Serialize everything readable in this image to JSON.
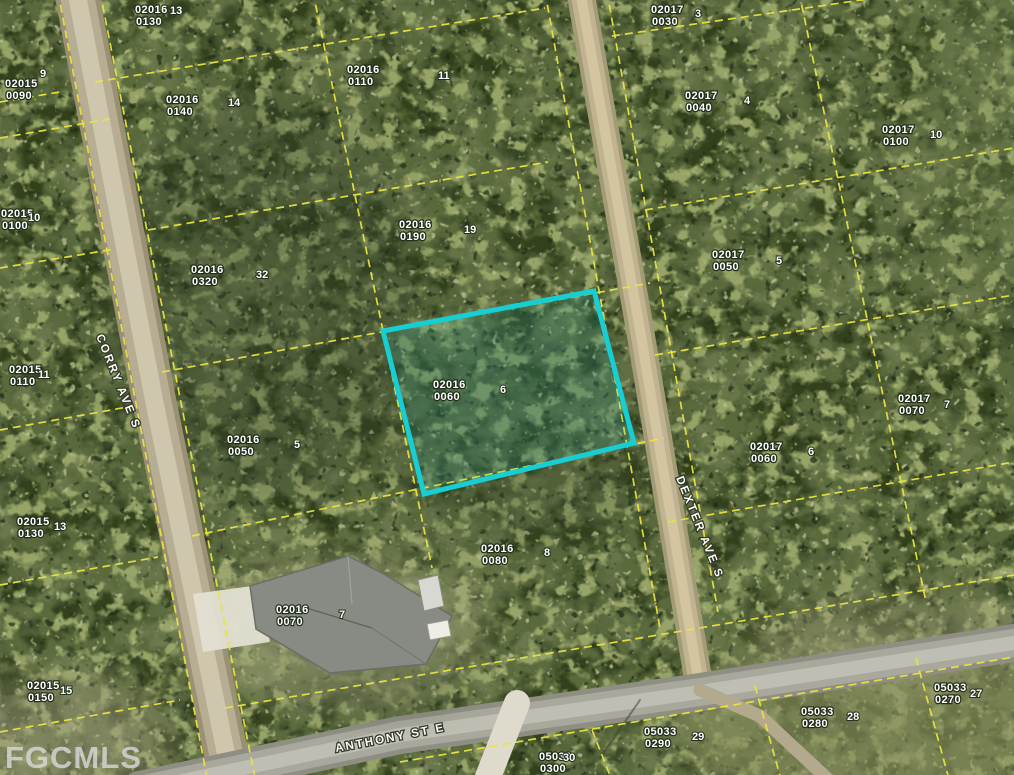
{
  "app": {
    "watermark": "FGCMLS"
  },
  "map": {
    "background_color": "#6a774c",
    "parcel_line_color": "#e9e43f",
    "highlight_color": "#17ced4",
    "label_color": "#ffffff",
    "streets": [
      {
        "name": "CORRY AVE S",
        "x": 96,
        "y": 336,
        "rotation": 68
      },
      {
        "name": "DEXTER AVE S",
        "x": 676,
        "y": 478,
        "rotation": 68
      },
      {
        "name": "ANTHONY ST E",
        "x": 336,
        "y": 752,
        "rotation": -11
      }
    ],
    "highlighted_parcel": {
      "block": "02016",
      "lot": "0060",
      "lot_number": "6",
      "points": "383,331 594,291 634,443 424,494"
    },
    "parcel_labels": [
      {
        "block": "02016",
        "lot": "0130",
        "x": 135,
        "y": 4,
        "num": "13",
        "nx": 170,
        "ny": 5
      },
      {
        "block": "02016",
        "lot": "0140",
        "x": 166,
        "y": 94,
        "num": "14",
        "nx": 228,
        "ny": 97
      },
      {
        "block": "02016",
        "lot": "0110",
        "x": 347,
        "y": 64,
        "num": "11",
        "nx": 438,
        "ny": 70
      },
      {
        "block": "02016",
        "lot": "0190",
        "x": 399,
        "y": 219,
        "num": "19",
        "nx": 464,
        "ny": 224
      },
      {
        "block": "02016",
        "lot": "0320",
        "x": 191,
        "y": 264,
        "num": "32",
        "nx": 256,
        "ny": 269
      },
      {
        "block": "02016",
        "lot": "0050",
        "x": 227,
        "y": 434,
        "num": "5",
        "nx": 294,
        "ny": 439
      },
      {
        "block": "02016",
        "lot": "0080",
        "x": 481,
        "y": 543,
        "num": "8",
        "nx": 544,
        "ny": 547
      },
      {
        "block": "02016",
        "lot": "0070",
        "x": 276,
        "y": 604,
        "num": "7",
        "nx": 339,
        "ny": 609
      },
      {
        "block": "02017",
        "lot": "0030",
        "x": 651,
        "y": 4,
        "num": "3",
        "nx": 695,
        "ny": 8
      },
      {
        "block": "02017",
        "lot": "0040",
        "x": 685,
        "y": 90,
        "num": "4",
        "nx": 744,
        "ny": 95
      },
      {
        "block": "02017",
        "lot": "0100",
        "x": 882,
        "y": 124,
        "num": "10",
        "nx": 930,
        "ny": 129
      },
      {
        "block": "02017",
        "lot": "0050",
        "x": 712,
        "y": 249,
        "num": "5",
        "nx": 776,
        "ny": 255
      },
      {
        "block": "02017",
        "lot": "0060",
        "x": 750,
        "y": 441,
        "num": "6",
        "nx": 808,
        "ny": 446
      },
      {
        "block": "02017",
        "lot": "0070",
        "x": 898,
        "y": 393,
        "num": "7",
        "nx": 944,
        "ny": 399
      },
      {
        "block": "02015",
        "lot": "0090",
        "x": 5,
        "y": 78,
        "num": "9",
        "nx": 40,
        "ny": 68
      },
      {
        "block": "02015",
        "lot": "0100",
        "x": 1,
        "y": 208,
        "num": "10",
        "nx": 28,
        "ny": 212
      },
      {
        "block": "02015",
        "lot": "0110",
        "x": 9,
        "y": 364,
        "num": "11",
        "nx": 38,
        "ny": 369
      },
      {
        "block": "02015",
        "lot": "0130",
        "x": 17,
        "y": 516,
        "num": "13",
        "nx": 54,
        "ny": 521
      },
      {
        "block": "02015",
        "lot": "0150",
        "x": 27,
        "y": 680,
        "num": "15",
        "nx": 60,
        "ny": 685
      },
      {
        "block": "05033",
        "lot": "0270",
        "x": 934,
        "y": 682,
        "num": "27",
        "nx": 970,
        "ny": 688
      },
      {
        "block": "05033",
        "lot": "0280",
        "x": 801,
        "y": 706,
        "num": "28",
        "nx": 847,
        "ny": 711
      },
      {
        "block": "05033",
        "lot": "0290",
        "x": 644,
        "y": 726,
        "num": "29",
        "nx": 692,
        "ny": 731
      },
      {
        "block": "05033",
        "lot": "0300",
        "x": 539,
        "y": 751,
        "num": "30",
        "nx": 563,
        "ny": 752
      }
    ],
    "parcel_lines": [
      [
        58,
        -8,
        208,
        783
      ],
      [
        100,
        -8,
        256,
        783
      ],
      [
        313,
        -8,
        432,
        568
      ],
      [
        545,
        -8,
        660,
        628
      ],
      [
        607,
        -8,
        718,
        612
      ],
      [
        799,
        -8,
        926,
        602
      ],
      [
        755,
        686,
        782,
        783
      ],
      [
        916,
        658,
        950,
        783
      ],
      [
        592,
        730,
        613,
        783
      ],
      [
        0,
        102,
        60,
        92
      ],
      [
        95,
        82,
        545,
        8
      ],
      [
        148,
        230,
        548,
        162
      ],
      [
        162,
        372,
        650,
        283
      ],
      [
        192,
        536,
        664,
        438
      ],
      [
        0,
        138,
        110,
        119
      ],
      [
        0,
        268,
        115,
        249
      ],
      [
        0,
        430,
        133,
        406
      ],
      [
        0,
        585,
        158,
        557
      ],
      [
        0,
        732,
        180,
        700
      ],
      [
        612,
        36,
        1014,
        -22
      ],
      [
        645,
        210,
        1014,
        148
      ],
      [
        655,
        355,
        1014,
        295
      ],
      [
        668,
        522,
        1014,
        462
      ],
      [
        225,
        708,
        1014,
        575
      ],
      [
        400,
        762,
        1014,
        657
      ]
    ]
  }
}
